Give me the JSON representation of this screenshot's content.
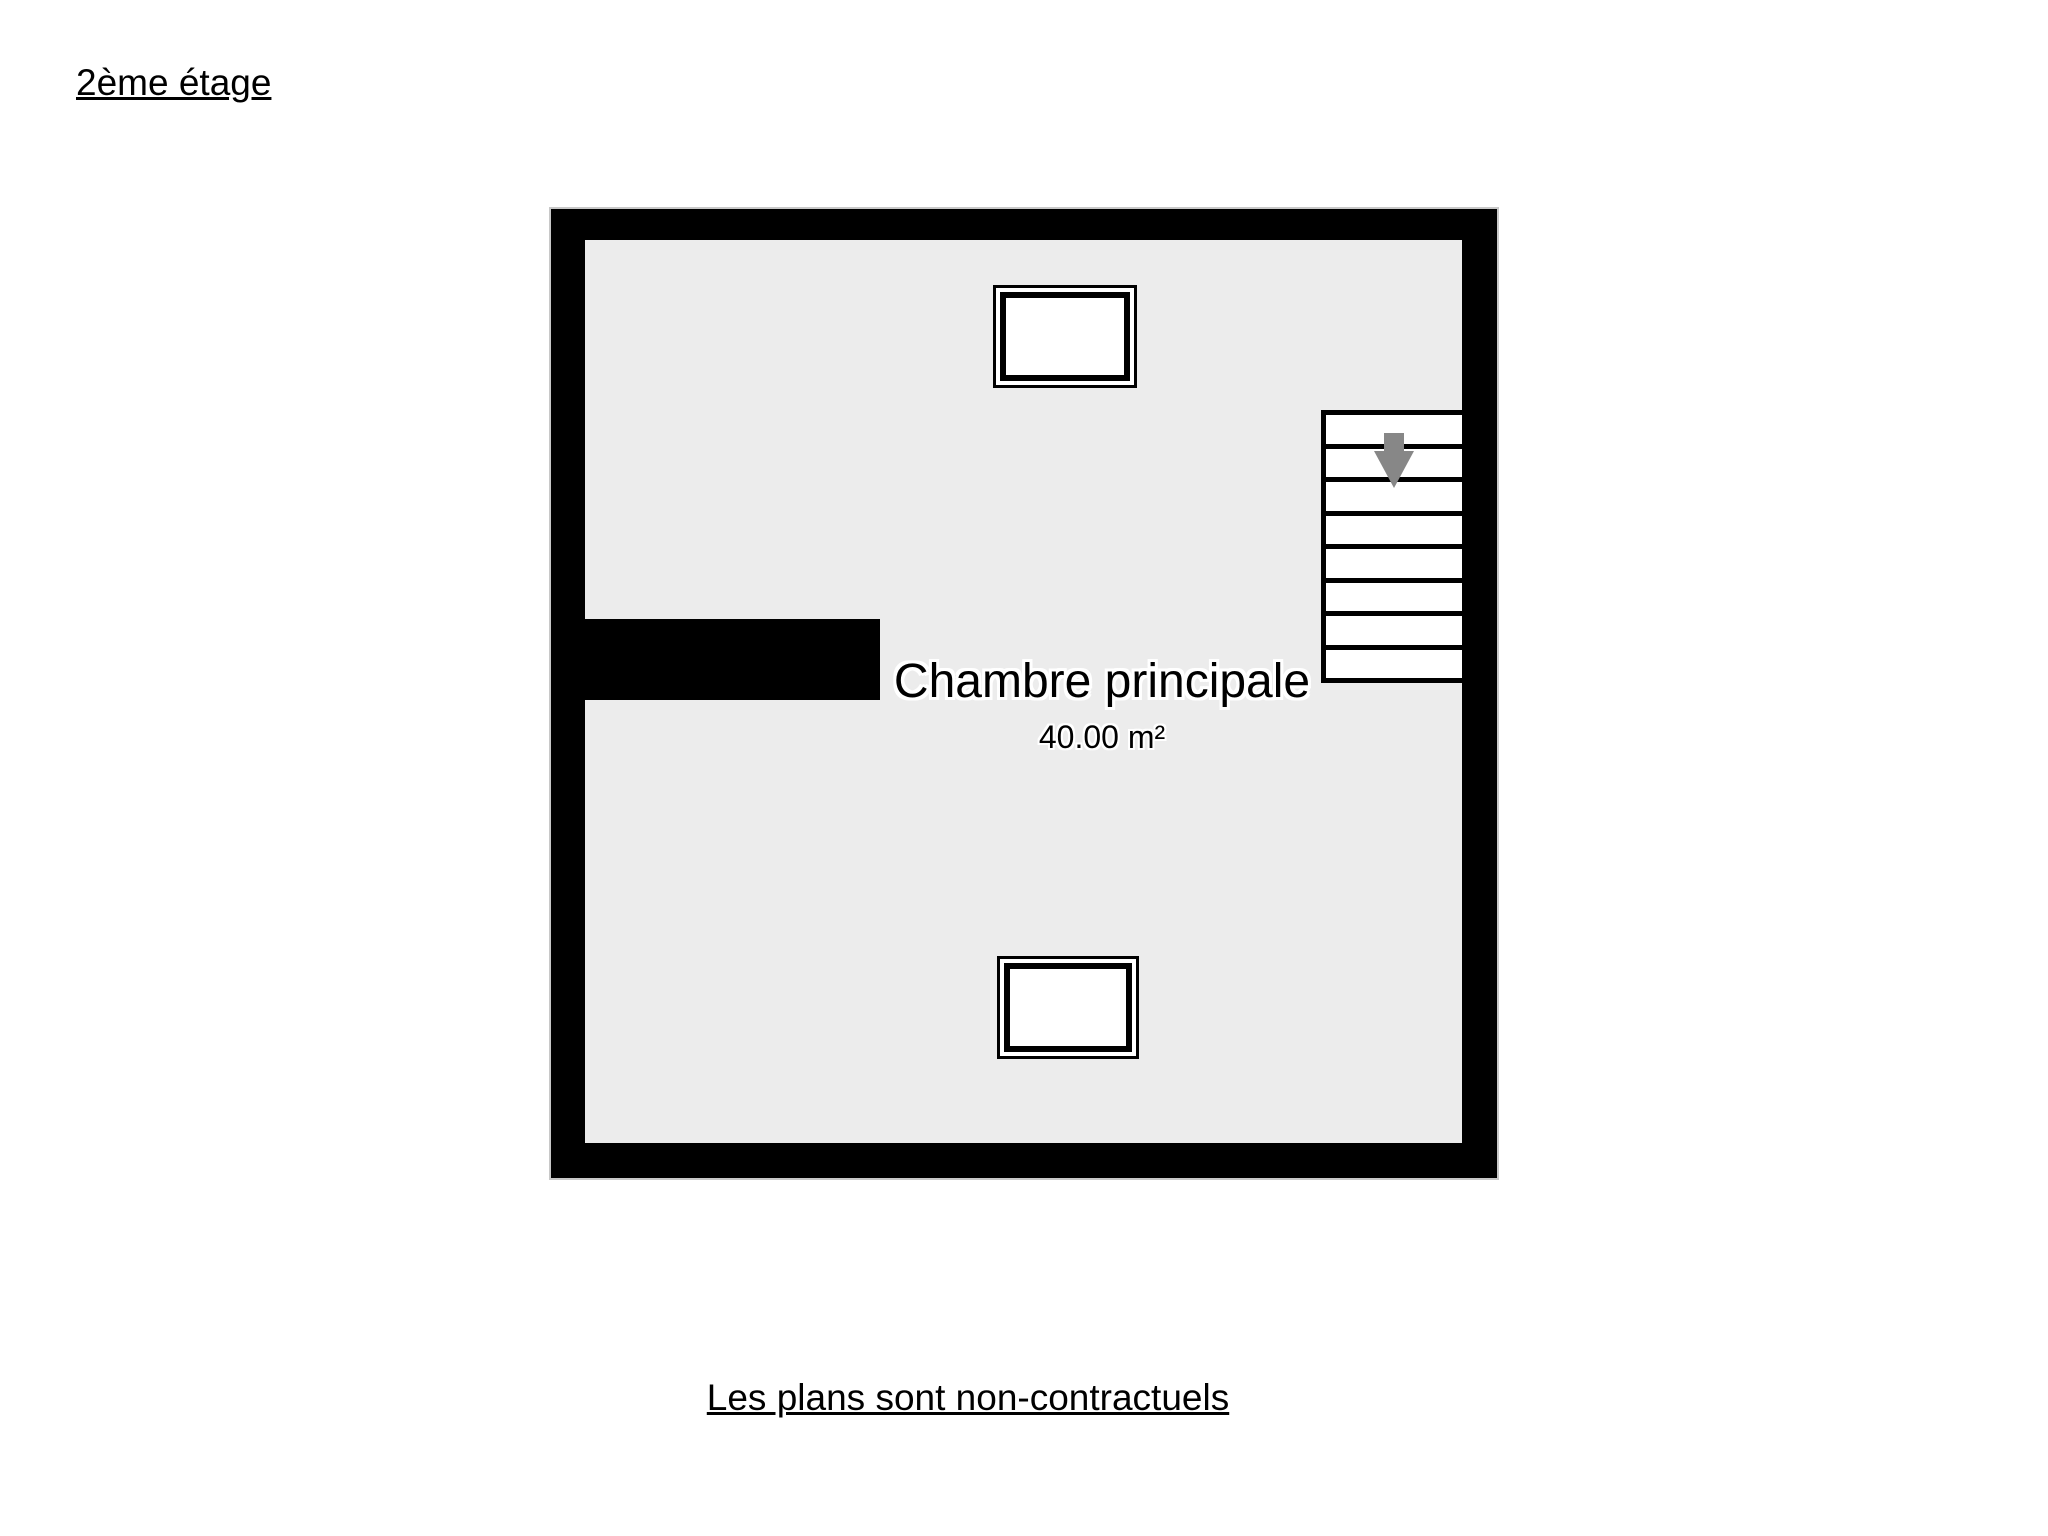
{
  "page": {
    "title": "2ème étage",
    "disclaimer": "Les plans sont non-contractuels"
  },
  "floorplan": {
    "room": {
      "name": "Chambre principale",
      "area": "40.00 m²"
    },
    "stairs": {
      "steps": 8,
      "direction": "down",
      "icon": "arrow-down-icon"
    },
    "windows": [
      {
        "position": "top"
      },
      {
        "position": "bottom"
      }
    ],
    "colors": {
      "background": "#ffffff",
      "wall": "#000000",
      "floor": "#ececec",
      "window_fill": "#ffffff",
      "stair_fill": "#ffffff",
      "arrow": "#878787",
      "plan_outline": "#c8c8c8",
      "text": "#000000"
    }
  }
}
